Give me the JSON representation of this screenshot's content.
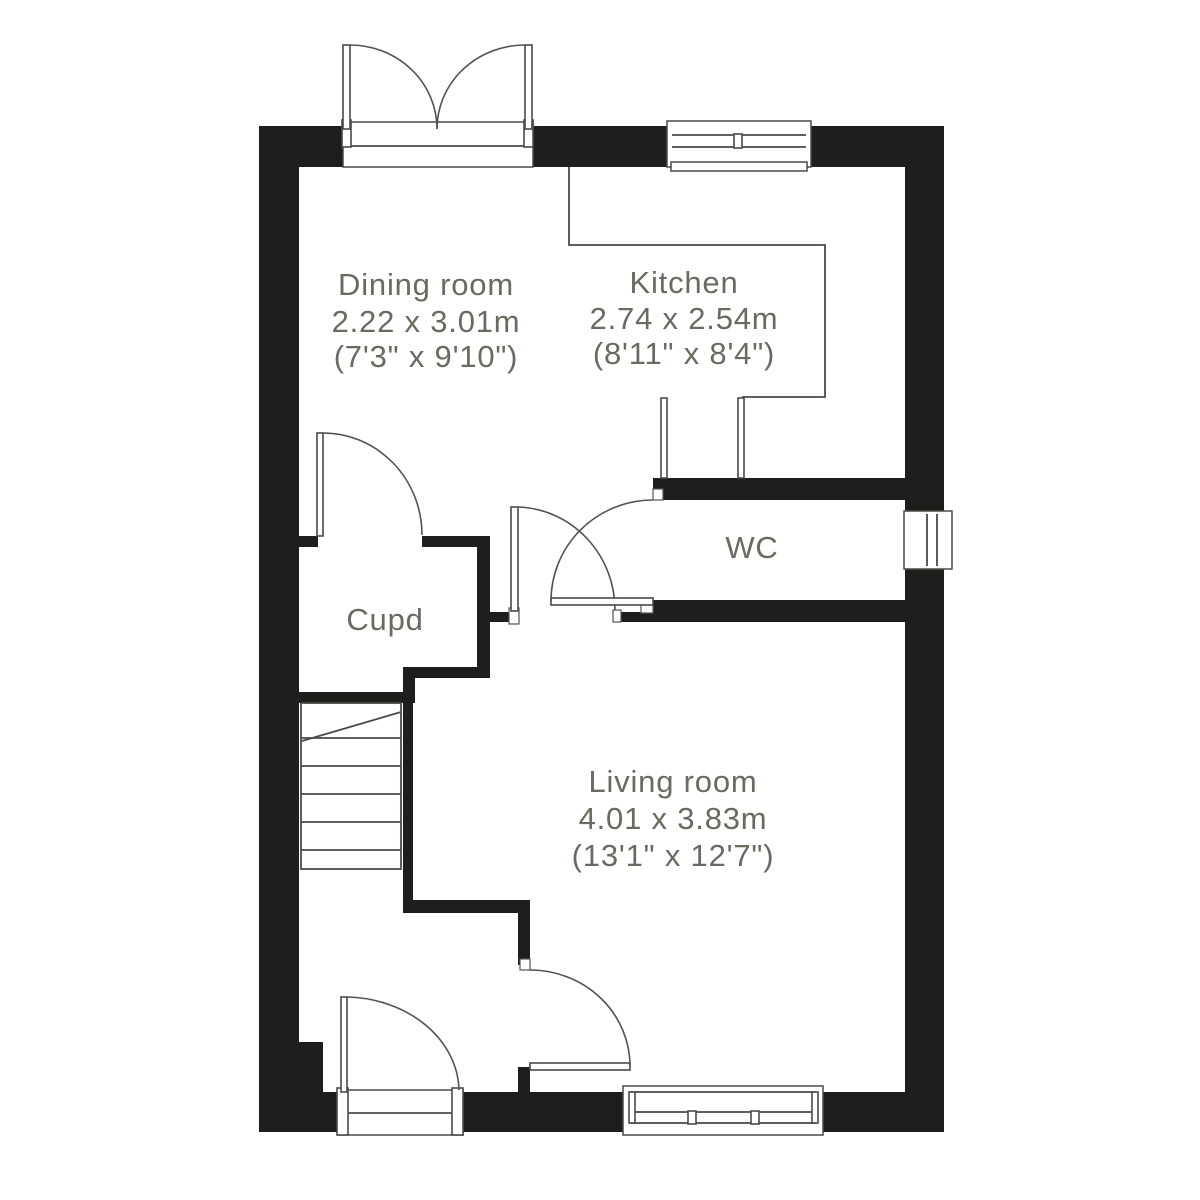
{
  "plan": {
    "type": "ground-floor-plan",
    "colors": {
      "wall": "#201e1d",
      "line": "#4c4a47",
      "label_text": "#6a6a61",
      "background": "#ffffff"
    },
    "rooms": {
      "dining": {
        "name": "Dining room",
        "metric": "2.22 x 3.01m",
        "imperial": "(7'3\" x 9'10\")"
      },
      "kitchen": {
        "name": "Kitchen",
        "metric": "2.74 x 2.54m",
        "imperial": "(8'11\" x 8'4\")"
      },
      "wc": {
        "name": "WC"
      },
      "cupboard": {
        "name": "Cupd"
      },
      "living": {
        "name": "Living room",
        "metric": "4.01 x 3.83m",
        "imperial": "(13'1\" x 12'7\")"
      }
    },
    "features": [
      "french-doors-top",
      "kitchen-window-top",
      "wc-window-right",
      "living-room-window-bottom",
      "front-door-bottom",
      "staircase",
      "cupboard-door",
      "wc-door",
      "living-room-door-upper",
      "living-room-door-lower"
    ]
  }
}
